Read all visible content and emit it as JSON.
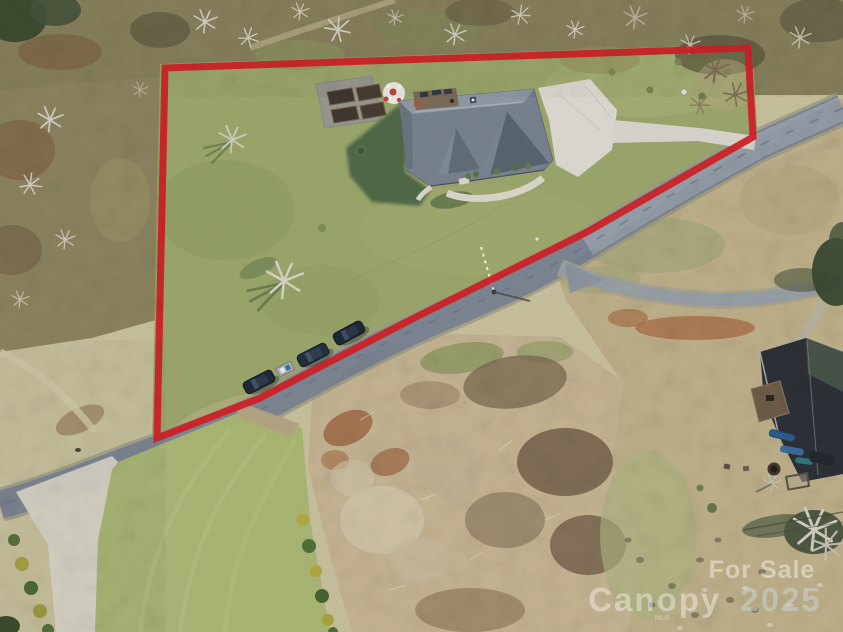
{
  "image": {
    "width": 843,
    "height": 632,
    "description": "Aerial drone photo of a for-sale property with a red lot-boundary outline, a gray-roofed house with driveway, a diagonal road with parked cars, brush field and neighboring home",
    "type": "aerial-photo"
  },
  "watermark": {
    "line1": "For Sale",
    "line2_word": "Canopy",
    "line2_year": "2025",
    "fine_print": "MLS",
    "color": "#ffffff",
    "year_color": "#cfe4ee"
  },
  "boundary": {
    "color": "#d02127",
    "stroke_width": 7,
    "vertices": [
      [
        165,
        68
      ],
      [
        748,
        48
      ],
      [
        753,
        137
      ],
      [
        587,
        232
      ],
      [
        420,
        315
      ],
      [
        260,
        398
      ],
      [
        157,
        438
      ]
    ]
  },
  "palette": {
    "lawn": "#9aa56b",
    "bright_lawn": "#a8b574",
    "road": "#7c8492",
    "branch_road": "#9aa2a8",
    "concrete": "#dad8d0",
    "woods": "#87805c",
    "woods_left": "#8d8560",
    "brush_field": "#c6b694",
    "pale_field": "#c6bf9c",
    "right_field": "#c0b28b",
    "roof": "#77818d",
    "neighbor_roof": "#2d3137",
    "shadow_green": "#3e5a3c",
    "car_body": "#1f2a38"
  },
  "scene": {
    "parked_cars": 3,
    "garden_beds": 4,
    "houses": 2
  }
}
